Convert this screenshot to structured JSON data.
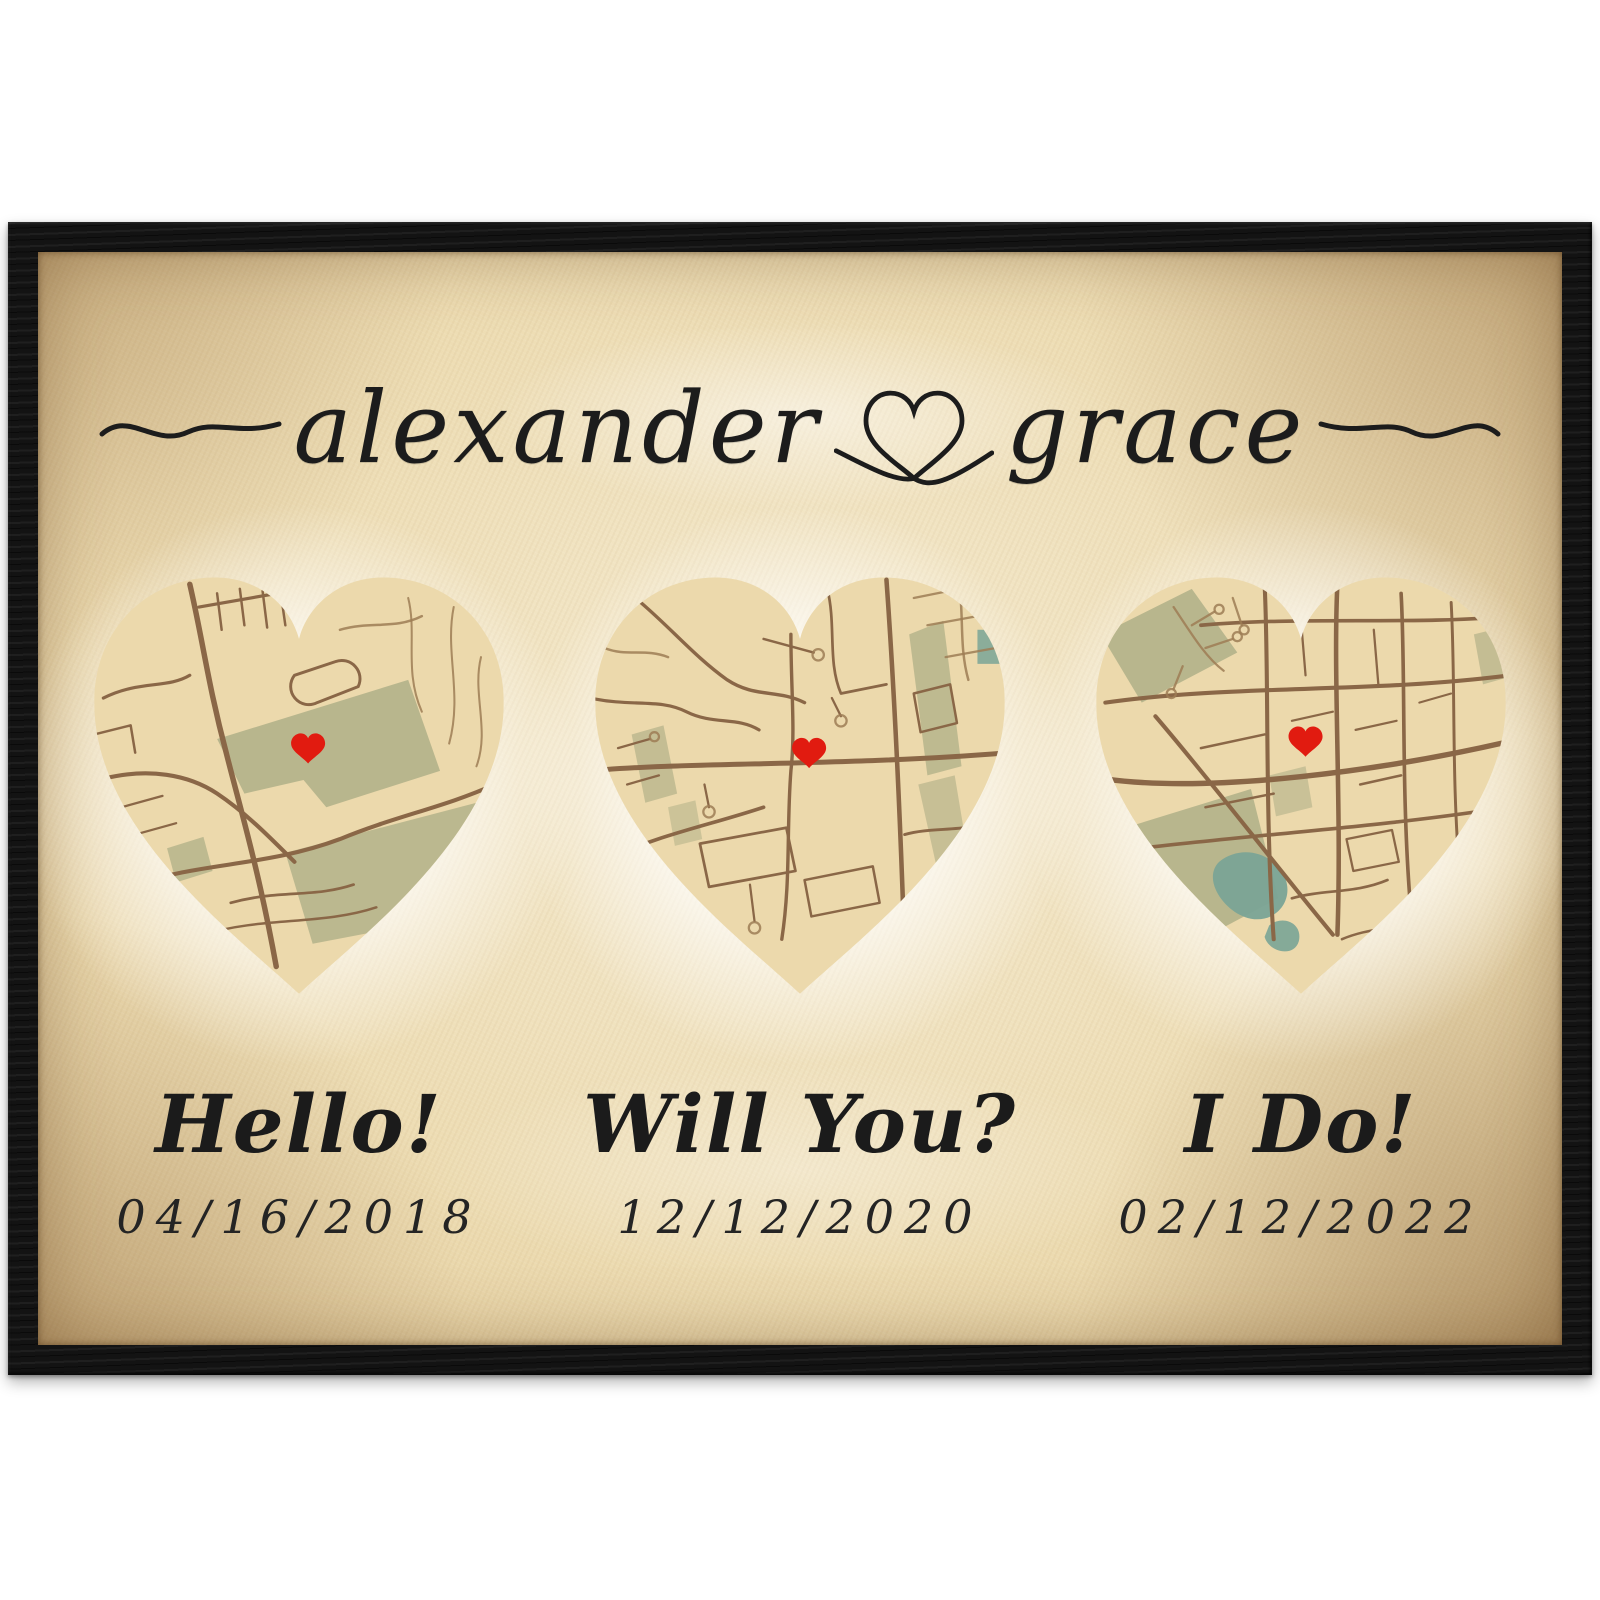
{
  "poster": {
    "couple": {
      "name_left": "alexander",
      "name_right": "grace",
      "heart_glyph": "♡"
    },
    "milestones": [
      {
        "label": "Hello!",
        "date": "04/16/2018"
      },
      {
        "label": "Will You?",
        "date": "12/12/2020"
      },
      {
        "label": "I Do!",
        "date": "02/12/2022"
      }
    ],
    "colors": {
      "frame_black": "#131313",
      "parchment_center": "#f5ebd1",
      "parchment_edge": "#bd9465",
      "map_base": "#ecd9ac",
      "road_brown": "#8a6747",
      "park_green": "#b3b189",
      "water_teal": "#7aa496",
      "marker_red": "#e11b10",
      "ink": "#1d1d1d"
    }
  }
}
